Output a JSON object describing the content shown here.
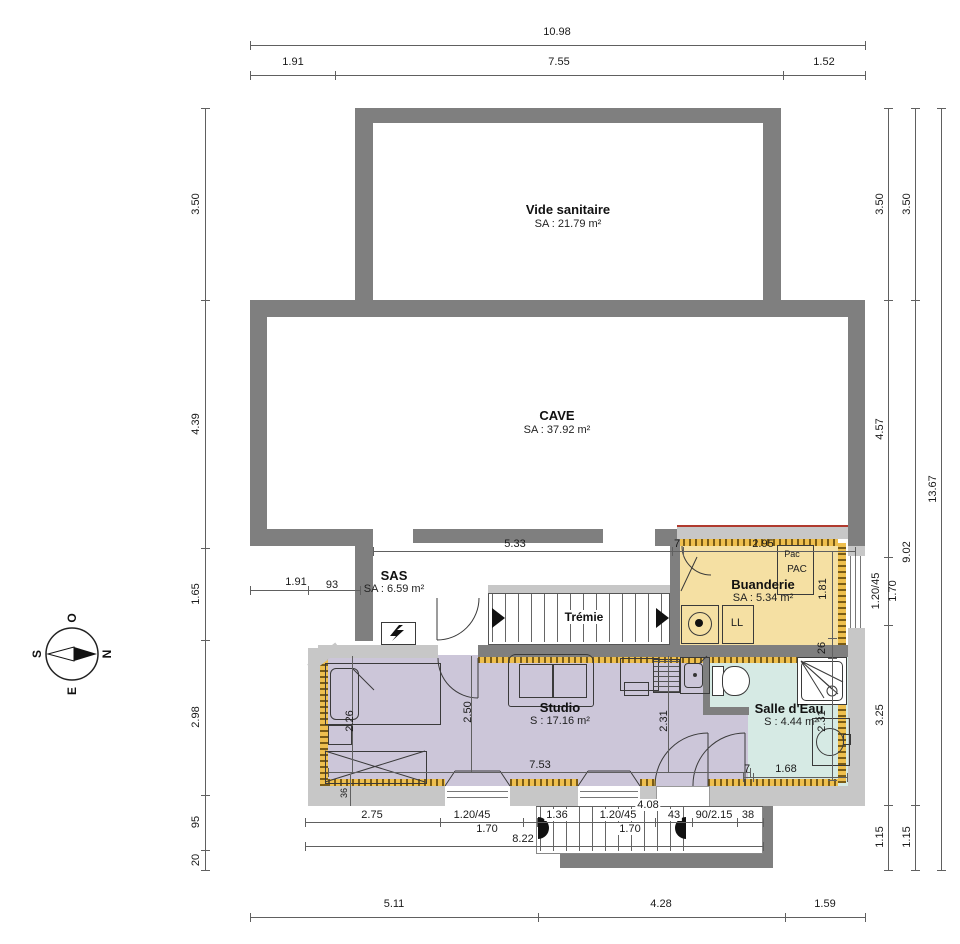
{
  "compass": {
    "top": "O",
    "right": "N",
    "bottom": "E",
    "left": "S"
  },
  "rooms": {
    "vide_sanitaire": {
      "name": "Vide sanitaire",
      "area": "SA : 21.79 m²"
    },
    "cave": {
      "name": "CAVE",
      "area": "SA : 37.92 m²"
    },
    "sas": {
      "name": "SAS",
      "area": "SA : 6.59 m²"
    },
    "buanderie": {
      "name": "Buanderie",
      "area": "SA : 5.34 m²"
    },
    "studio": {
      "name": "Studio",
      "area": "S : 17.16 m²"
    },
    "salle_deau": {
      "name": "Salle d'Eau",
      "area": "S : 4.44 m²"
    }
  },
  "equipment": {
    "tremie": "Trémie",
    "pac_label": "Pac",
    "pac_unit": "PAC",
    "washer": "LL"
  },
  "dims": {
    "top": {
      "total": "10.98",
      "segs": [
        "1.91",
        "7.55",
        "1.52"
      ]
    },
    "left": [
      "3.50",
      "4.39",
      "1.65",
      "2.98",
      "95",
      "20"
    ],
    "right_inner": [
      "3.50",
      "4.57",
      "1.20/45",
      "1.70",
      "3.25",
      "1.15"
    ],
    "right_mid": [
      "3.50",
      "9.02",
      "1.15"
    ],
    "right_outer": "13.67",
    "bottom": [
      "5.11",
      "4.28",
      "1.59"
    ],
    "interior": {
      "sas_width": "5.33",
      "door7": "7",
      "buand_width": "2.95",
      "buand_depth": "1.81",
      "cave_a": "1.91",
      "cave_b": "93",
      "wall26": "26",
      "studio_a": "2.26",
      "studio_b": "2.50",
      "studio_c": "2.31",
      "studio_w": "7.53",
      "sill36": "36",
      "sde_depth": "2.31",
      "sde_door7": "7",
      "sde_w": "1.68",
      "ext_stair": "4.08",
      "chain": [
        "2.75",
        "1.20/45",
        "1.70",
        "1.36",
        "1.20/45",
        "1.70",
        "43",
        "90/2.15",
        "38"
      ],
      "chain_total": "8.22"
    }
  },
  "colors": {
    "wall_dark": "#7f7f7f",
    "wall_light": "#c7c7c7",
    "buanderie_fill": "#f5e0a3",
    "studio_fill": "#ccc6d9",
    "salle_deau_fill": "#d6eae4",
    "insulation": "#e8b23a",
    "accent_red": "#b03a2e"
  }
}
